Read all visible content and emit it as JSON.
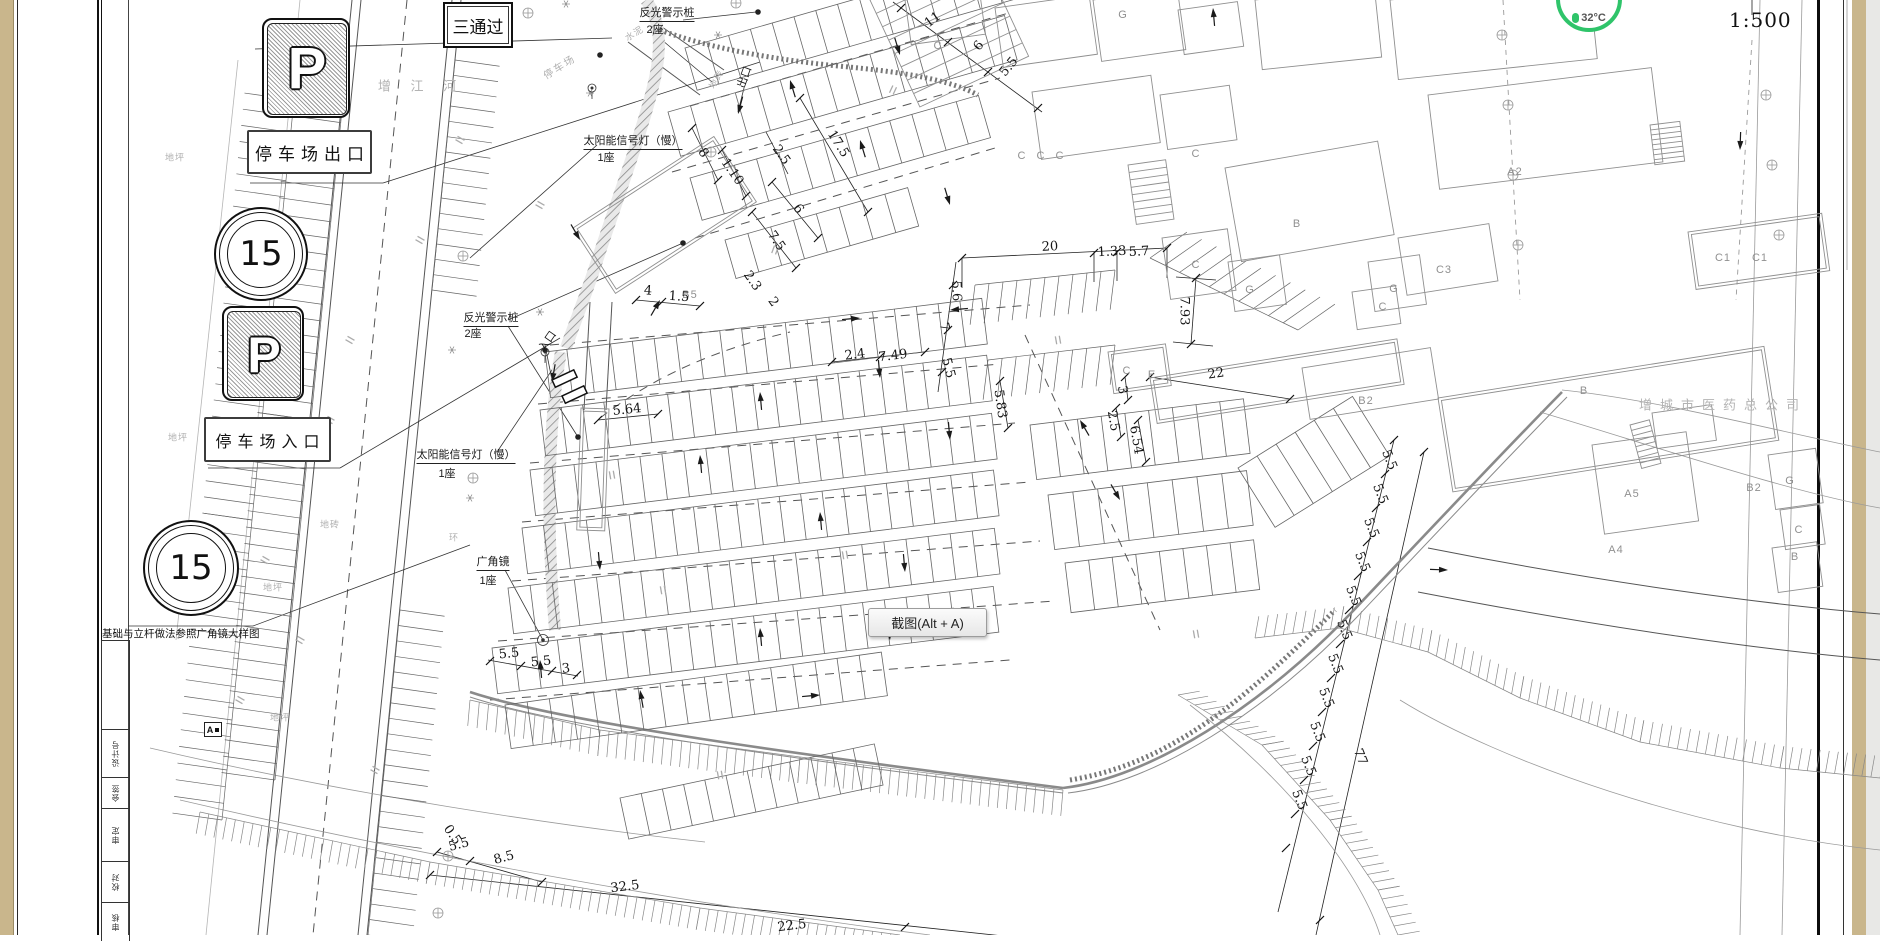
{
  "scale": {
    "value": "1:500"
  },
  "overlay": {
    "screenshot_tooltip": "截图(Alt + A)",
    "weather": {
      "temp": "32°C"
    }
  },
  "legend": {
    "pass_sign": "三通过",
    "p_letter": "P",
    "exit_box": "停车场出口",
    "entrance_box": "停车场入口",
    "speed_limit": "15",
    "footing_note": "基础与立杆做法参照广角镜大样图",
    "detail_marker": "A"
  },
  "titleblock": {
    "cells": [
      "设计号",
      "会签",
      "审定",
      "校对",
      "审核"
    ]
  },
  "annotations": [
    {
      "t": "反光警示桩",
      "x": 667,
      "y": 13,
      "c": "lb u"
    },
    {
      "t": "2座",
      "x": 655,
      "y": 29,
      "c": "lb"
    },
    {
      "t": "反光警示桩",
      "x": 491,
      "y": 318,
      "c": "lb u"
    },
    {
      "t": "2座",
      "x": 473,
      "y": 333,
      "c": "lb"
    },
    {
      "t": "太阳能信号灯（慢）",
      "x": 633,
      "y": 141,
      "c": "lb u"
    },
    {
      "t": "1座",
      "x": 606,
      "y": 157,
      "c": "lb"
    },
    {
      "t": "太阳能信号灯（慢）",
      "x": 466,
      "y": 455,
      "c": "lb u"
    },
    {
      "t": "1座",
      "x": 447,
      "y": 473,
      "c": "lb"
    },
    {
      "t": "广角镜",
      "x": 493,
      "y": 562,
      "c": "lb u"
    },
    {
      "t": "1座",
      "x": 488,
      "y": 580,
      "c": "lb"
    },
    {
      "t": "入口",
      "x": 547,
      "y": 341,
      "r": -55,
      "c": "lb"
    },
    {
      "t": "出口",
      "x": 744,
      "y": 77,
      "r": -70,
      "c": "lb"
    },
    {
      "t": "增 江 河",
      "x": 421,
      "y": 85,
      "c": "fx big"
    },
    {
      "t": "停车场",
      "x": 559,
      "y": 66,
      "r": -32,
      "c": "fx"
    },
    {
      "t": "水泥",
      "x": 634,
      "y": 33,
      "r": -32,
      "c": "fx sm"
    },
    {
      "t": "地坪",
      "x": 175,
      "y": 157,
      "c": "fx sm"
    },
    {
      "t": "地坪",
      "x": 178,
      "y": 437,
      "c": "fx sm"
    },
    {
      "t": "地坪",
      "x": 273,
      "y": 587,
      "c": "fx sm"
    },
    {
      "t": "地坪",
      "x": 280,
      "y": 717,
      "c": "fx sm"
    },
    {
      "t": "地砖",
      "x": 330,
      "y": 524,
      "c": "fx sm"
    },
    {
      "t": "地砖",
      "x": 716,
      "y": 79,
      "r": -60,
      "c": "fx sm"
    },
    {
      "t": "环",
      "x": 454,
      "y": 537,
      "c": "fx sm"
    },
    {
      "t": "增城市医药总公司",
      "x": 1723,
      "y": 404,
      "c": "fx big"
    },
    {
      "t": "B5",
      "x": 690,
      "y": 295,
      "c": "bl"
    },
    {
      "t": "C",
      "x": 938,
      "y": 46,
      "c": "bl"
    },
    {
      "t": "G",
      "x": 1123,
      "y": 15,
      "c": "bl"
    },
    {
      "t": "C",
      "x": 1196,
      "y": 154,
      "c": "bl"
    },
    {
      "t": "C",
      "x": 1022,
      "y": 156,
      "c": "bl"
    },
    {
      "t": "C",
      "x": 1041,
      "y": 156,
      "c": "bl"
    },
    {
      "t": "C",
      "x": 1060,
      "y": 156,
      "c": "bl"
    },
    {
      "t": "B",
      "x": 1297,
      "y": 224,
      "c": "bl"
    },
    {
      "t": "A2",
      "x": 1515,
      "y": 172,
      "c": "bl"
    },
    {
      "t": "C3",
      "x": 1444,
      "y": 270,
      "c": "bl"
    },
    {
      "t": "C1",
      "x": 1723,
      "y": 258,
      "c": "bl"
    },
    {
      "t": "C1",
      "x": 1760,
      "y": 258,
      "c": "bl"
    },
    {
      "t": "C",
      "x": 1196,
      "y": 265,
      "c": "bl"
    },
    {
      "t": "G",
      "x": 1250,
      "y": 290,
      "c": "bl"
    },
    {
      "t": "G",
      "x": 1394,
      "y": 289,
      "c": "bl"
    },
    {
      "t": "C",
      "x": 1383,
      "y": 307,
      "c": "bl"
    },
    {
      "t": "C",
      "x": 1127,
      "y": 371,
      "c": "bl"
    },
    {
      "t": "E",
      "x": 1152,
      "y": 375,
      "c": "bl"
    },
    {
      "t": "B2",
      "x": 1366,
      "y": 401,
      "c": "bl"
    },
    {
      "t": "B2",
      "x": 1754,
      "y": 488,
      "c": "bl"
    },
    {
      "t": "B",
      "x": 1584,
      "y": 391,
      "c": "bl"
    },
    {
      "t": "A5",
      "x": 1632,
      "y": 494,
      "c": "bl"
    },
    {
      "t": "A4",
      "x": 1616,
      "y": 550,
      "c": "bl"
    },
    {
      "t": "G",
      "x": 1790,
      "y": 481,
      "c": "bl"
    },
    {
      "t": "C",
      "x": 1799,
      "y": 530,
      "c": "bl"
    },
    {
      "t": "B",
      "x": 1795,
      "y": 557,
      "c": "bl"
    },
    {
      "t": "20",
      "x": 1050,
      "y": 247,
      "r": -3,
      "c": "dm"
    },
    {
      "t": "1.33",
      "x": 1112,
      "y": 252,
      "r": -3,
      "c": "dm"
    },
    {
      "t": "5.7",
      "x": 1139,
      "y": 252,
      "r": -3,
      "c": "dm"
    },
    {
      "t": "7.93",
      "x": 1184,
      "y": 311,
      "r": 90,
      "c": "dm"
    },
    {
      "t": "22",
      "x": 1216,
      "y": 374,
      "r": -8,
      "c": "dm"
    },
    {
      "t": "5.83",
      "x": 1000,
      "y": 404,
      "r": 82,
      "c": "dm"
    },
    {
      "t": "3",
      "x": 1122,
      "y": 390,
      "r": 80,
      "c": "dm"
    },
    {
      "t": "2.5",
      "x": 1113,
      "y": 421,
      "r": 80,
      "c": "dm"
    },
    {
      "t": "6.54",
      "x": 1136,
      "y": 440,
      "r": 80,
      "c": "dm"
    },
    {
      "t": "5.5",
      "x": 948,
      "y": 368,
      "r": 75,
      "c": "dm"
    },
    {
      "t": "7",
      "x": 944,
      "y": 327,
      "r": 75,
      "c": "dm"
    },
    {
      "t": "5.6",
      "x": 956,
      "y": 291,
      "r": 88,
      "c": "dm"
    },
    {
      "t": "7.49",
      "x": 893,
      "y": 356,
      "r": -7,
      "c": "dm"
    },
    {
      "t": "2.4",
      "x": 855,
      "y": 355,
      "r": -7,
      "c": "dm"
    },
    {
      "t": "5.64",
      "x": 627,
      "y": 410,
      "r": -6,
      "c": "dm"
    },
    {
      "t": "17.5",
      "x": 838,
      "y": 144,
      "r": 58,
      "c": "dm"
    },
    {
      "t": "8",
      "x": 703,
      "y": 153,
      "r": 55,
      "c": "dm"
    },
    {
      "t": "1.10",
      "x": 732,
      "y": 172,
      "r": 55,
      "c": "dm"
    },
    {
      "t": "6",
      "x": 798,
      "y": 209,
      "r": 55,
      "c": "dm"
    },
    {
      "t": "7.5",
      "x": 776,
      "y": 241,
      "r": 55,
      "c": "dm"
    },
    {
      "t": "2.5",
      "x": 781,
      "y": 155,
      "r": 55,
      "c": "dm"
    },
    {
      "t": "2.3",
      "x": 752,
      "y": 281,
      "r": 55,
      "c": "dm"
    },
    {
      "t": "2",
      "x": 773,
      "y": 302,
      "r": 55,
      "c": "dm"
    },
    {
      "t": "11",
      "x": 933,
      "y": 20,
      "r": -37,
      "c": "dm"
    },
    {
      "t": "6",
      "x": 979,
      "y": 46,
      "r": -50,
      "c": "dm"
    },
    {
      "t": "5.5",
      "x": 1009,
      "y": 67,
      "r": -50,
      "c": "dm"
    },
    {
      "t": "4",
      "x": 648,
      "y": 291,
      "r": 4,
      "c": "dm"
    },
    {
      "t": "1.5",
      "x": 679,
      "y": 297,
      "r": 4,
      "c": "dm"
    },
    {
      "t": "5.5",
      "x": 509,
      "y": 654,
      "r": -6,
      "c": "dm"
    },
    {
      "t": "5.5",
      "x": 541,
      "y": 662,
      "r": -6,
      "c": "dm"
    },
    {
      "t": "3",
      "x": 566,
      "y": 669,
      "r": -6,
      "c": "dm"
    },
    {
      "t": "0.5",
      "x": 452,
      "y": 835,
      "r": 55,
      "c": "dm"
    },
    {
      "t": "5.5",
      "x": 459,
      "y": 845,
      "r": -15,
      "c": "dm"
    },
    {
      "t": "8.5",
      "x": 504,
      "y": 858,
      "r": -15,
      "c": "dm"
    },
    {
      "t": "32.5",
      "x": 625,
      "y": 887,
      "r": -7,
      "c": "dm"
    },
    {
      "t": "22.5",
      "x": 792,
      "y": 926,
      "r": -7,
      "c": "dm"
    },
    {
      "t": "5.5",
      "x": 1389,
      "y": 460,
      "r": 68,
      "c": "dm"
    },
    {
      "t": "5.5",
      "x": 1380,
      "y": 494,
      "r": 68,
      "c": "dm"
    },
    {
      "t": "5.5",
      "x": 1371,
      "y": 528,
      "r": 68,
      "c": "dm"
    },
    {
      "t": "5.5",
      "x": 1362,
      "y": 562,
      "r": 68,
      "c": "dm"
    },
    {
      "t": "5.5",
      "x": 1353,
      "y": 596,
      "r": 68,
      "c": "dm"
    },
    {
      "t": "5.5",
      "x": 1344,
      "y": 630,
      "r": 68,
      "c": "dm"
    },
    {
      "t": "5.5",
      "x": 1335,
      "y": 664,
      "r": 68,
      "c": "dm"
    },
    {
      "t": "5.5",
      "x": 1326,
      "y": 698,
      "r": 68,
      "c": "dm"
    },
    {
      "t": "5.5",
      "x": 1317,
      "y": 732,
      "r": 68,
      "c": "dm"
    },
    {
      "t": "5.5",
      "x": 1308,
      "y": 766,
      "r": 68,
      "c": "dm"
    },
    {
      "t": "5.5",
      "x": 1299,
      "y": 800,
      "r": 68,
      "c": "dm"
    },
    {
      "t": "77",
      "x": 1360,
      "y": 757,
      "r": 68,
      "c": "dm"
    }
  ]
}
